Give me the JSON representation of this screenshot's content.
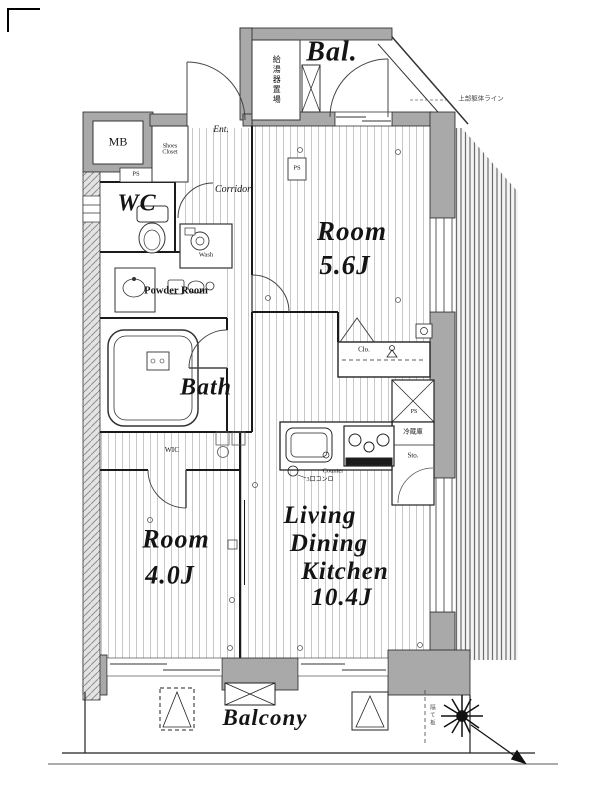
{
  "labels": {
    "bal": "Bal.",
    "water_heater": "給湯器置場",
    "upper_note": "上部躯体ライン",
    "mb": "MB",
    "ps_entrance": "PS",
    "ps_top": "PS",
    "shoes_line1": "Shoes",
    "shoes_line2": "Closet",
    "ent": "Ent.",
    "corridor": "Corridor",
    "wc": "WC",
    "wash": "Wash",
    "powder_room": "Powder Room",
    "bath": "Bath",
    "wic": "WIC",
    "room1_line1": "Room",
    "room1_line2": "5.6J",
    "clo": "Clo.",
    "ps_kitchen": "PS",
    "fridge": "冷蔵庫",
    "storage": "Sto.",
    "counter": "Counter",
    "stove_note": "3口コンロ",
    "room2_line1": "Room",
    "room2_line2": "4.0J",
    "ldk_line1": "Living",
    "ldk_line2": "Dining",
    "ldk_line3": "Kitchen",
    "ldk_line4": "10.4J",
    "balcony_bottom": "Balcony",
    "partition_note": "隔て板"
  },
  "colors": {
    "wall_gray": "#a9a9a9",
    "line_black": "#1a1a1a",
    "floor_stripe": "#c8c8c8",
    "hatch_gray": "#8f8f8f",
    "paper_white": "#ffffff"
  }
}
